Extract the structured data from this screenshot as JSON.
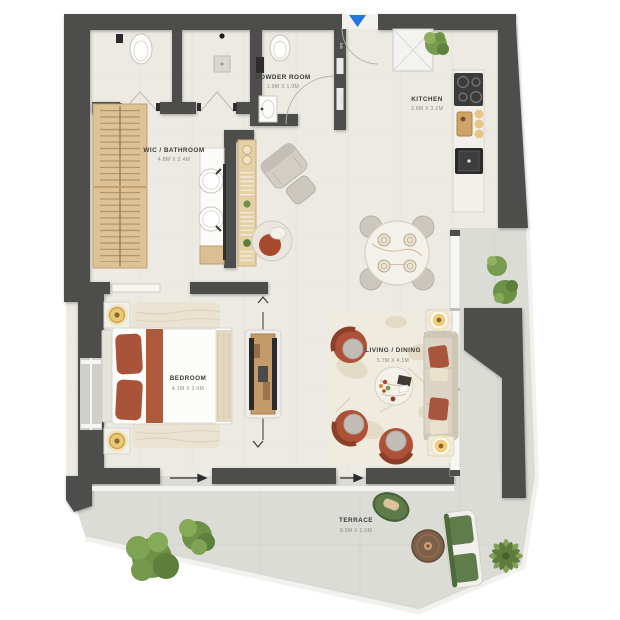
{
  "plan": {
    "rooms": [
      {
        "id": "powder",
        "name": "POWDER ROOM",
        "dims": "1.9M X 1.0M"
      },
      {
        "id": "kitchen",
        "name": "KITCHEN",
        "dims": "3.6M X 3.1M"
      },
      {
        "id": "wic",
        "name": "WIC / BATHROOM",
        "dims": "4.8M X 2.4M"
      },
      {
        "id": "bedroom",
        "name": "BEDROOM",
        "dims": "4.1M X 3.0M"
      },
      {
        "id": "living",
        "name": "LIVING / DINING",
        "dims": "5.7M X 4.1M"
      },
      {
        "id": "terrace",
        "name": "TERRACE",
        "dims": "8.5M X 1.5M"
      }
    ],
    "wall_tags": {
      "db": "DB",
      "onu": "ONU"
    },
    "colors": {
      "wall": "#4e4e4c",
      "floor": "#eceae3",
      "terrace_floor": "#dcdcd7",
      "accent_terracotta": "#ad5138",
      "wood": "#d8bf94",
      "plant_green": "#6d9146",
      "entry_marker_blue": "#2176e0",
      "marble": "#f3f0ea",
      "lamp_gold": "#e9c877"
    }
  }
}
